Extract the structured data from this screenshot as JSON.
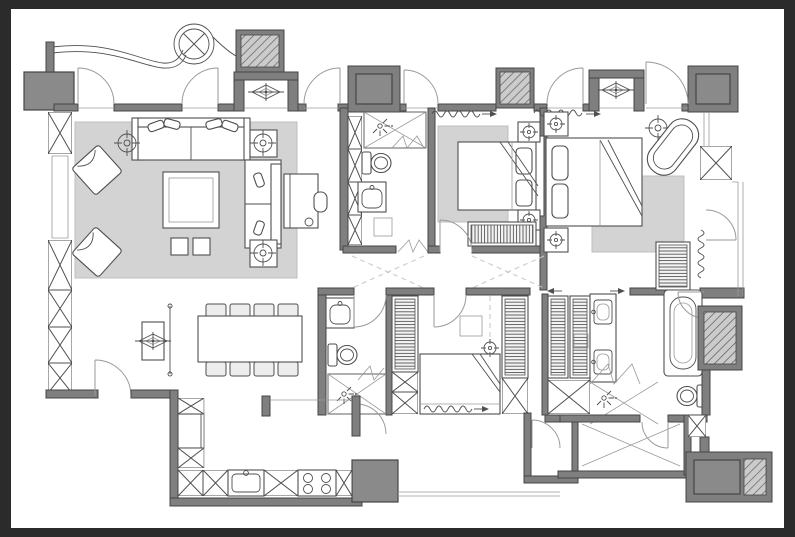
{
  "canvas": {
    "width": 795,
    "height": 537,
    "viewBox": "0 0 795 537"
  },
  "colors": {
    "frame": "#2b2b2b",
    "paper": "#ffffff",
    "wall_fill": "#7f7f7f",
    "wall_stroke": "#454545",
    "column_fill": "#9c9c9c",
    "column_inner": "#8a8a8a",
    "line": "#4f4f4f",
    "line_light": "#9a9a9a",
    "furn": "#ffffff",
    "furn_gray": "#ededed",
    "rug": "#d3d3d3",
    "rug_stroke": "#bfbfbf",
    "hatch_bg": "#cbcbcb",
    "hatch_line": "#5e5e5e",
    "dash": "#c6c6c6"
  },
  "drawing": {
    "type": "apartment-floor-plan",
    "style": "monochrome architectural linework on white sheet with dark border",
    "symbols": {
      "circled_x": "entry ceiling light / canopy fixture",
      "diamond": "ceiling diffuser in wall niche",
      "wavy_line_with_arrow": "window curtain / opening direction mark",
      "x_box": "window mullion or cabinet carcass",
      "hatched_block": "duct / service shaft",
      "gray_block": "structural column",
      "dashed_diagonals": "corridor sight lines",
      "double_headed_arrows": "sliding wardrobe doors"
    },
    "rooms": [
      {
        "name": "entry-porch",
        "features": [
          "canopy-curves",
          "ceiling-light",
          "swing-doors",
          "diffuser-niche"
        ]
      },
      {
        "name": "living-room",
        "features": [
          "area-rug",
          "main-sofa",
          "side-sofa",
          "coffee-table",
          "two-stools",
          "two-armchairs",
          "round-side-table",
          "two-lamp-tables",
          "desk-with-chair"
        ]
      },
      {
        "name": "dining-area",
        "features": [
          "eight-seat-table",
          "sideboard",
          "diffuser",
          "screen-line"
        ]
      },
      {
        "name": "kitchen",
        "features": [
          "l-counter",
          "sink",
          "cooktop-4-burner",
          "tall-cabinet",
          "column"
        ]
      },
      {
        "name": "bathroom-1",
        "features": [
          "shower",
          "toilet",
          "basin",
          "cabinet-stack",
          "bifold-door"
        ]
      },
      {
        "name": "bedroom-2",
        "features": [
          "double-bed",
          "rug",
          "two-nightstands",
          "dresser",
          "curtain-mark"
        ]
      },
      {
        "name": "bedroom-3-master",
        "features": [
          "double-bed",
          "rug",
          "freestanding-bathtub",
          "side-table",
          "louver-screen",
          "balcony-door"
        ]
      },
      {
        "name": "bedroom-4",
        "features": [
          "double-bed",
          "two-wardrobes",
          "wall-desk",
          "ceiling-fan"
        ]
      },
      {
        "name": "bathroom-2",
        "features": [
          "basin",
          "toilet",
          "shower"
        ]
      },
      {
        "name": "master-bathroom",
        "features": [
          "walk-in-closet",
          "double-vanity",
          "bathtub",
          "shower",
          "toilet"
        ]
      },
      {
        "name": "laundry-room",
        "features": [
          "swing-door"
        ]
      },
      {
        "name": "storage-room",
        "features": [
          "cross-marked-floor",
          "swing-door"
        ]
      },
      {
        "name": "service-core",
        "features": [
          "solid-block",
          "hatched-shaft"
        ]
      },
      {
        "name": "balcony",
        "features": [
          "railing",
          "curtain-wave"
        ]
      },
      {
        "name": "corridor",
        "features": [
          "dashed-sight-lines"
        ]
      }
    ]
  }
}
